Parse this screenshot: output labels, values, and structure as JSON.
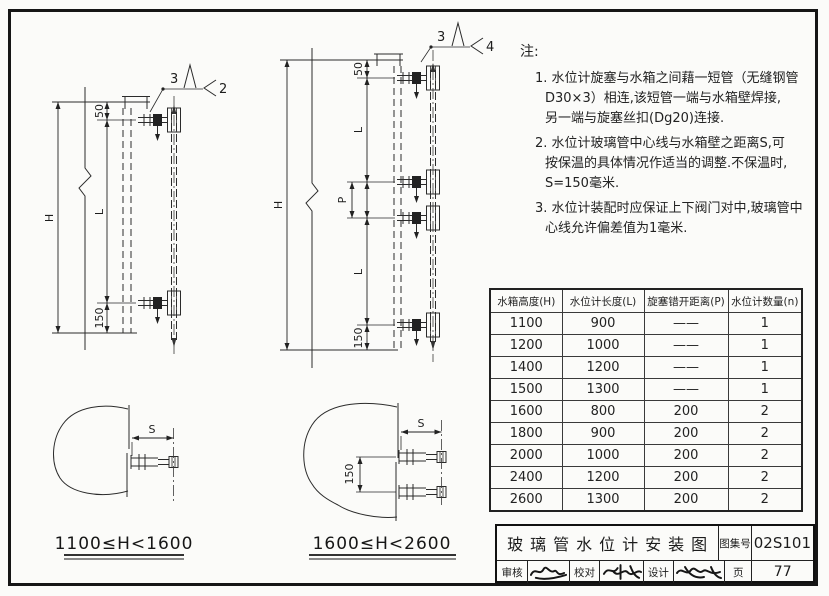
{
  "drawings": {
    "single": {
      "dim_h": "H",
      "dim_50": "50",
      "dim_l": "L",
      "dim_150": "150",
      "callout_item": "3",
      "callout_ref": "2"
    },
    "double": {
      "dim_h": "H",
      "dim_50": "50",
      "dim_l_upper": "L",
      "dim_p": "P",
      "dim_l_lower": "L",
      "dim_150": "150",
      "callout_item": "3",
      "callout_ref": "4"
    },
    "plan_single": {
      "dim_s": "S",
      "caption": "1100≤H<1600"
    },
    "plan_double": {
      "dim_s": "S",
      "dim_150": "150",
      "caption": "1600≤H<2600"
    }
  },
  "notes": {
    "label": "注:",
    "n1_l1": "1. 水位计旋塞与水箱之间藉一短管（无缝钢管",
    "n1_l2": "D30×3）相连,该短管一端与水箱壁焊接,",
    "n1_l3": "另一端与旋塞丝扣(Dg20)连接.",
    "n2_l1": "2. 水位计玻璃管中心线与水箱壁之距离S,可",
    "n2_l2": "按保温的具体情况作适当的调整.不保温时,",
    "n2_l3": "S=150毫米.",
    "n3_l1": "3. 水位计装配时应保证上下阀门对中,玻璃管中",
    "n3_l2": "心线允许偏差值为1毫米."
  },
  "table": {
    "headers": [
      "水箱高度(H)",
      "水位计长度(L)",
      "旋塞错开距离(P)",
      "水位计数量(n)"
    ],
    "rows": [
      [
        "1100",
        "900",
        "——",
        "1"
      ],
      [
        "1200",
        "1000",
        "——",
        "1"
      ],
      [
        "1400",
        "1200",
        "——",
        "1"
      ],
      [
        "1500",
        "1300",
        "——",
        "1"
      ],
      [
        "1600",
        "800",
        "200",
        "2"
      ],
      [
        "1800",
        "900",
        "200",
        "2"
      ],
      [
        "2000",
        "1000",
        "200",
        "2"
      ],
      [
        "2400",
        "1200",
        "200",
        "2"
      ],
      [
        "2600",
        "1300",
        "200",
        "2"
      ]
    ]
  },
  "title_block": {
    "title": "玻璃管水位计安装图",
    "atlas_label": "图集号",
    "atlas_no": "02S101",
    "page_label": "页",
    "page_no": "77",
    "review_label": "审核",
    "check_label": "校对",
    "design_label": "设计"
  }
}
